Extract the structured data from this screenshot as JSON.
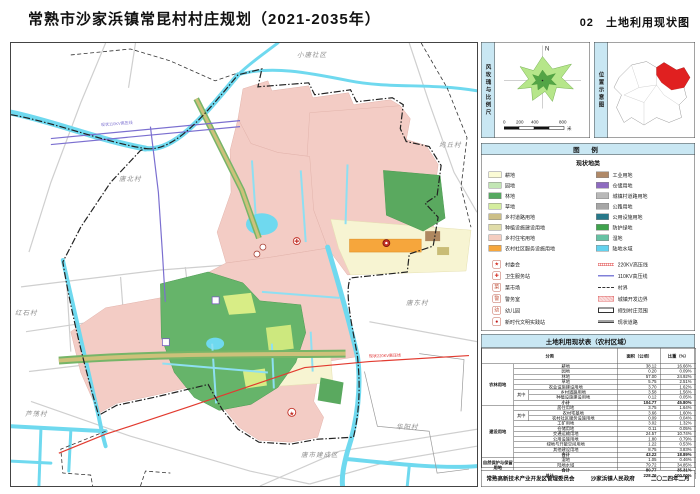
{
  "header": {
    "title": "常熟市沙家浜镇常昆村村庄规划（2021-2035年）",
    "sheet_no": "02",
    "sheet_name": "土地利用现状图"
  },
  "windrose": {
    "label": "风玫瑰与比例尺",
    "north": "N",
    "scale_ticks": [
      "0",
      "200",
      "400",
      "800"
    ],
    "scale_unit": "米"
  },
  "location": {
    "label": "位置示意图"
  },
  "legend": {
    "title": "图  例",
    "landuse_title": "现状地类",
    "landuse_left": [
      {
        "label": "耕地",
        "color": "#FBFBD5"
      },
      {
        "label": "园地",
        "color": "#C2E6B4"
      },
      {
        "label": "林地",
        "color": "#55A860"
      },
      {
        "label": "草地",
        "color": "#D4ED9E"
      },
      {
        "label": "乡村道路用地",
        "color": "#CCBF87"
      },
      {
        "label": "种植设施建设用地",
        "color": "#E0DCA8"
      },
      {
        "label": "乡村住宅用地",
        "color": "#F4CDC0"
      },
      {
        "label": "农村社区服务设施用地",
        "color": "#F6A63C"
      }
    ],
    "landuse_right": [
      {
        "label": "工业用地",
        "color": "#B08968"
      },
      {
        "label": "仓储用地",
        "color": "#8E6BC0"
      },
      {
        "label": "城镇村道路用地",
        "color": "#B9B9B9"
      },
      {
        "label": "公路用地",
        "color": "#A6A6A6"
      },
      {
        "label": "公用设施用地",
        "color": "#27798A"
      },
      {
        "label": "防护绿地",
        "color": "#3FA34D"
      },
      {
        "label": "湿地",
        "color": "#66C2A4"
      },
      {
        "label": "陆地水域",
        "color": "#63D2EE"
      }
    ],
    "markers": [
      {
        "label": "村委会",
        "glyph": "★",
        "color": "#D42B20"
      },
      {
        "label": "卫生服务站",
        "glyph": "✚",
        "color": "#D42B20"
      },
      {
        "label": "菜市场",
        "glyph": "菜",
        "color": "#C2533C"
      },
      {
        "label": "警务室",
        "glyph": "警",
        "color": "#C2533C"
      },
      {
        "label": "幼儿园",
        "glyph": "幼",
        "color": "#C2533C"
      },
      {
        "label": "新时代文明实践站",
        "glyph": "●",
        "color": "#C01818"
      }
    ],
    "lines": [
      {
        "label": "220KV高压线",
        "type": "hv220"
      },
      {
        "label": "110KV高压线",
        "type": "hv110"
      },
      {
        "label": "村界",
        "type": "vboundary"
      },
      {
        "label": "城镇开发边界",
        "type": "devboundary"
      },
      {
        "label": "规划村庄范围",
        "type": "extent"
      },
      {
        "label": "现状道路",
        "type": "road"
      }
    ]
  },
  "table": {
    "title": "土地利用现状表（农村区域）",
    "headers": [
      [
        "分类",
        3
      ],
      [
        "面积（公顷）",
        1
      ],
      [
        "比重（%）",
        1
      ]
    ],
    "rows": [
      [
        [
          "农林用地",
          1,
          8,
          "grp"
        ],
        [
          "耕地",
          2,
          1
        ],
        [
          "38.12",
          1,
          1,
          "num"
        ],
        [
          "16.66%",
          1,
          1,
          "num"
        ]
      ],
      [
        [
          "园地",
          2,
          1
        ],
        [
          "0.20",
          1,
          1,
          "num"
        ],
        [
          "0.09%",
          1,
          1,
          "num"
        ]
      ],
      [
        [
          "林地",
          2,
          1
        ],
        [
          "57.00",
          1,
          1,
          "num"
        ],
        [
          "24.92%",
          1,
          1,
          "num"
        ]
      ],
      [
        [
          "草地",
          2,
          1
        ],
        [
          "5.75",
          1,
          1,
          "num"
        ],
        [
          "2.51%",
          1,
          1,
          "num"
        ]
      ],
      [
        [
          "农业设施建设用地",
          2,
          1
        ],
        [
          "3.70",
          1,
          1,
          "num"
        ],
        [
          "1.62%",
          1,
          1,
          "num"
        ]
      ],
      [
        [
          "其中",
          1,
          2
        ],
        [
          "乡村道路用地",
          1,
          1
        ],
        [
          "3.58",
          1,
          1,
          "num"
        ],
        [
          "1.56%",
          1,
          1,
          "num"
        ]
      ],
      [
        [
          "种植设施建设用地",
          1,
          1
        ],
        [
          "0.12",
          1,
          1,
          "num"
        ],
        [
          "0.05%",
          1,
          1,
          "num"
        ]
      ],
      [
        [
          "小计",
          2,
          1,
          "sum"
        ],
        [
          "104.77",
          1,
          1,
          "num sum"
        ],
        [
          "45.80%",
          1,
          1,
          "num sum"
        ]
      ],
      [
        [
          "建设用地",
          1,
          10,
          "grp"
        ],
        [
          "居住用地",
          2,
          1
        ],
        [
          "3.75",
          1,
          1,
          "num"
        ],
        [
          "1.64%",
          1,
          1,
          "num"
        ]
      ],
      [
        [
          "其中",
          1,
          2
        ],
        [
          "农村宅基地",
          1,
          1
        ],
        [
          "3.66",
          1,
          1,
          "num"
        ],
        [
          "1.60%",
          1,
          1,
          "num"
        ]
      ],
      [
        [
          "农村社区服务设施用地",
          1,
          1
        ],
        [
          "0.09",
          1,
          1,
          "num"
        ],
        [
          "0.04%",
          1,
          1,
          "num"
        ]
      ],
      [
        [
          "工矿用地",
          2,
          1
        ],
        [
          "3.02",
          1,
          1,
          "num"
        ],
        [
          "1.32%",
          1,
          1,
          "num"
        ]
      ],
      [
        [
          "仓储用地",
          2,
          1
        ],
        [
          "0.11",
          1,
          1,
          "num"
        ],
        [
          "0.05%",
          1,
          1,
          "num"
        ]
      ],
      [
        [
          "交通运输用地",
          2,
          1
        ],
        [
          "24.57",
          1,
          1,
          "num"
        ],
        [
          "10.74%",
          1,
          1,
          "num"
        ]
      ],
      [
        [
          "公用设施用地",
          2,
          1
        ],
        [
          "1.80",
          1,
          1,
          "num"
        ],
        [
          "0.79%",
          1,
          1,
          "num"
        ]
      ],
      [
        [
          "绿地与开敞空间用地",
          2,
          1
        ],
        [
          "1.22",
          1,
          1,
          "num"
        ],
        [
          "0.53%",
          1,
          1,
          "num"
        ]
      ],
      [
        [
          "其他建设用地",
          2,
          1
        ],
        [
          "8.75",
          1,
          1,
          "num"
        ],
        [
          "3.83%",
          1,
          1,
          "num"
        ]
      ],
      [
        [
          "合计",
          2,
          1,
          "sum"
        ],
        [
          "43.22",
          1,
          1,
          "num sum"
        ],
        [
          "18.89%",
          1,
          1,
          "num sum"
        ]
      ],
      [
        [
          "自然保护与保留用地",
          1,
          3,
          "grp"
        ],
        [
          "湿地",
          2,
          1
        ],
        [
          "1.05",
          1,
          1,
          "num"
        ],
        [
          "0.46%",
          1,
          1,
          "num"
        ]
      ],
      [
        [
          "陆地水域",
          2,
          1
        ],
        [
          "79.72",
          1,
          1,
          "num"
        ],
        [
          "34.85%",
          1,
          1,
          "num"
        ]
      ],
      [
        [
          "合计",
          2,
          1,
          "sum"
        ],
        [
          "80.77",
          1,
          1,
          "num sum"
        ],
        [
          "35.31%",
          1,
          1,
          "num sum"
        ]
      ],
      [
        [
          "总计",
          3,
          1,
          "sum"
        ],
        [
          "228.76",
          1,
          1,
          "num sum"
        ],
        [
          "100.00%",
          1,
          1,
          "num sum"
        ]
      ]
    ]
  },
  "footer": {
    "org1": "常熟高新技术产业开发区管理委员会",
    "org2": "沙家浜镇人民政府",
    "date": "二〇二四年二月"
  },
  "map": {
    "labels": [
      {
        "text": "小唐社区",
        "x": 296,
        "y": 48,
        "cls": "vname"
      },
      {
        "text": "坞丘村",
        "x": 438,
        "y": 138,
        "cls": "vname"
      },
      {
        "text": "唐北村",
        "x": 118,
        "y": 172,
        "cls": "vname"
      },
      {
        "text": "红石村",
        "x": 14,
        "y": 306,
        "cls": "vname"
      },
      {
        "text": "唐东村",
        "x": 405,
        "y": 296,
        "cls": "vname"
      },
      {
        "text": "华阳村",
        "x": 395,
        "y": 420,
        "cls": "vname"
      },
      {
        "text": "芦荡村",
        "x": 24,
        "y": 407,
        "cls": "vname"
      },
      {
        "text": "唐市建成区",
        "x": 300,
        "y": 448,
        "cls": "vname"
      },
      {
        "text": "现状110KV高压线",
        "x": 100,
        "y": 120,
        "cls": "hv110",
        "rot": -4
      },
      {
        "text": "现状220KV高压线",
        "x": 368,
        "y": 352,
        "cls": "hv220",
        "rot": -2
      }
    ]
  }
}
